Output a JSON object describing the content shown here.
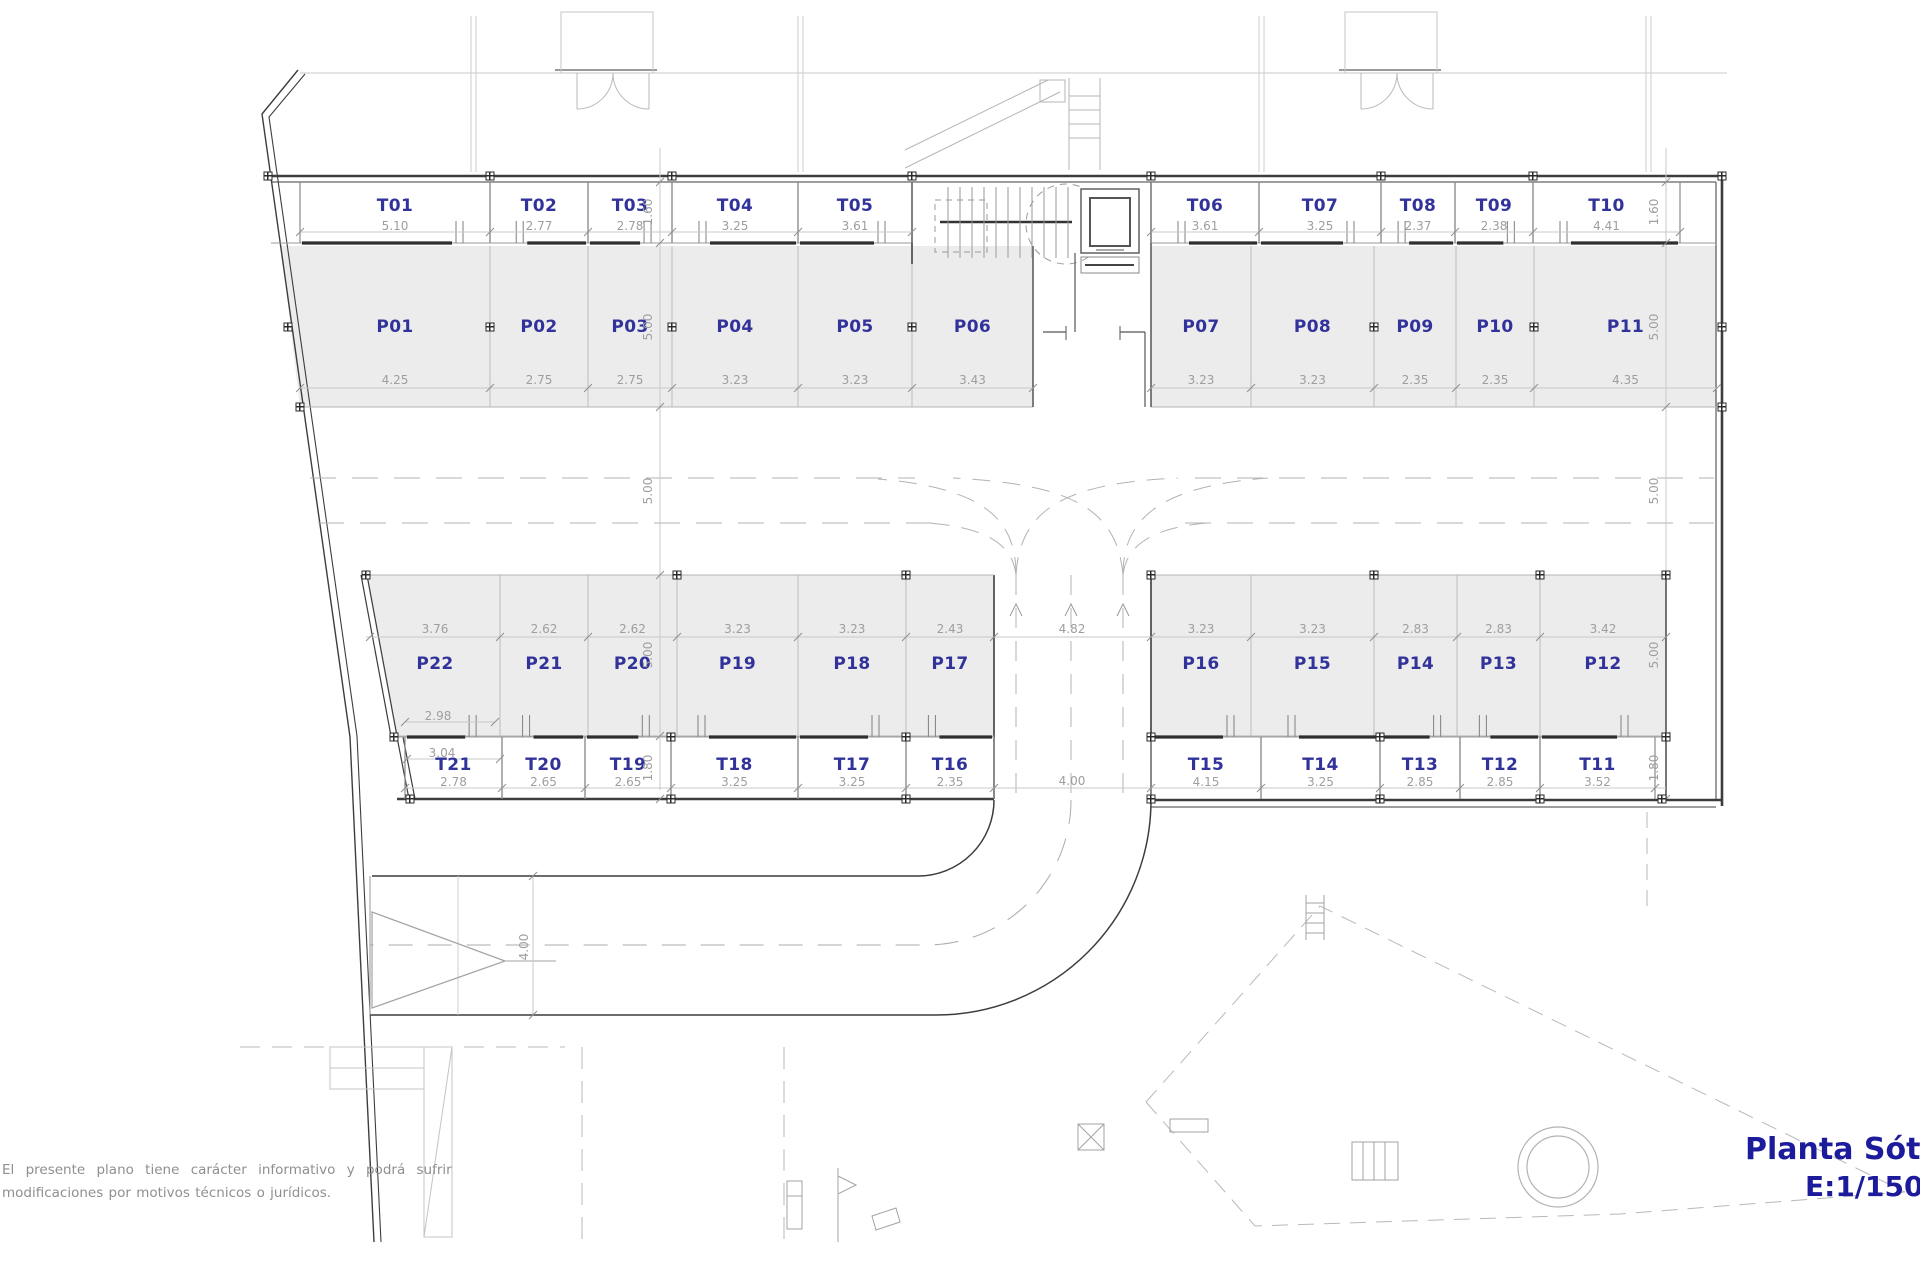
{
  "plan_title": {
    "name": "Planta Sótano",
    "scale": "E:1/150"
  },
  "disclaimer": {
    "line1": "El presente plano tiene carácter informativo y podrá sufrir",
    "line2": "modificaciones por motivos técnicos o jurídicos."
  },
  "colors": {
    "unit_label": "#32329b",
    "dimension_text": "#9e9e9e",
    "stall_fill": "#ececec",
    "wall": "#3d3d3d",
    "title_text": "#1b1b9b"
  },
  "storage_top": [
    {
      "id": "T01",
      "dim": "5.10"
    },
    {
      "id": "T02",
      "dim": "2.77"
    },
    {
      "id": "T03",
      "dim": "2.78"
    },
    {
      "id": "T04",
      "dim": "3.25"
    },
    {
      "id": "T05",
      "dim": "3.61"
    },
    {
      "id": "T06",
      "dim": "3.61"
    },
    {
      "id": "T07",
      "dim": "3.25"
    },
    {
      "id": "T08",
      "dim": "2.37"
    },
    {
      "id": "T09",
      "dim": "2.38"
    },
    {
      "id": "T10",
      "dim": "4.41"
    }
  ],
  "parking_top": [
    {
      "id": "P01",
      "dim": "4.25"
    },
    {
      "id": "P02",
      "dim": "2.75"
    },
    {
      "id": "P03",
      "dim": "2.75"
    },
    {
      "id": "P04",
      "dim": "3.23"
    },
    {
      "id": "P05",
      "dim": "3.23"
    },
    {
      "id": "P06",
      "dim": "3.43"
    },
    {
      "id": "P07",
      "dim": "3.23"
    },
    {
      "id": "P08",
      "dim": "3.23"
    },
    {
      "id": "P09",
      "dim": "2.35"
    },
    {
      "id": "P10",
      "dim": "2.35"
    },
    {
      "id": "P11",
      "dim": "4.35"
    }
  ],
  "parking_bottom": [
    {
      "id": "P22",
      "dim": "3.76"
    },
    {
      "id": "P21",
      "dim": "2.62"
    },
    {
      "id": "P20",
      "dim": "2.62"
    },
    {
      "id": "P19",
      "dim": "3.23"
    },
    {
      "id": "P18",
      "dim": "3.23"
    },
    {
      "id": "P17",
      "dim": "2.43"
    },
    {
      "id": "P16",
      "dim": "3.23"
    },
    {
      "id": "P15",
      "dim": "3.23"
    },
    {
      "id": "P14",
      "dim": "2.83"
    },
    {
      "id": "P13",
      "dim": "2.83"
    },
    {
      "id": "P12",
      "dim": "3.42"
    }
  ],
  "storage_bottom": [
    {
      "id": "T21",
      "dim": "2.78"
    },
    {
      "id": "T20",
      "dim": "2.65"
    },
    {
      "id": "T19",
      "dim": "2.65"
    },
    {
      "id": "T18",
      "dim": "3.25"
    },
    {
      "id": "T17",
      "dim": "3.25"
    },
    {
      "id": "T16",
      "dim": "2.35"
    },
    {
      "id": "T15",
      "dim": "4.15"
    },
    {
      "id": "T14",
      "dim": "3.25"
    },
    {
      "id": "T13",
      "dim": "2.85"
    },
    {
      "id": "T12",
      "dim": "2.85"
    },
    {
      "id": "T11",
      "dim": "3.52"
    }
  ],
  "vertical_dims": {
    "left": [
      "1.60",
      "5.00",
      "5.00",
      "5.00",
      "1.80"
    ],
    "right": [
      "1.60",
      "5.00",
      "5.00",
      "5.00",
      "1.80"
    ]
  },
  "extra_dims": [
    {
      "text": "2.98"
    },
    {
      "text": "3.04"
    },
    {
      "text": "4.82"
    },
    {
      "text": "4.00"
    },
    {
      "text": "4.00"
    }
  ]
}
